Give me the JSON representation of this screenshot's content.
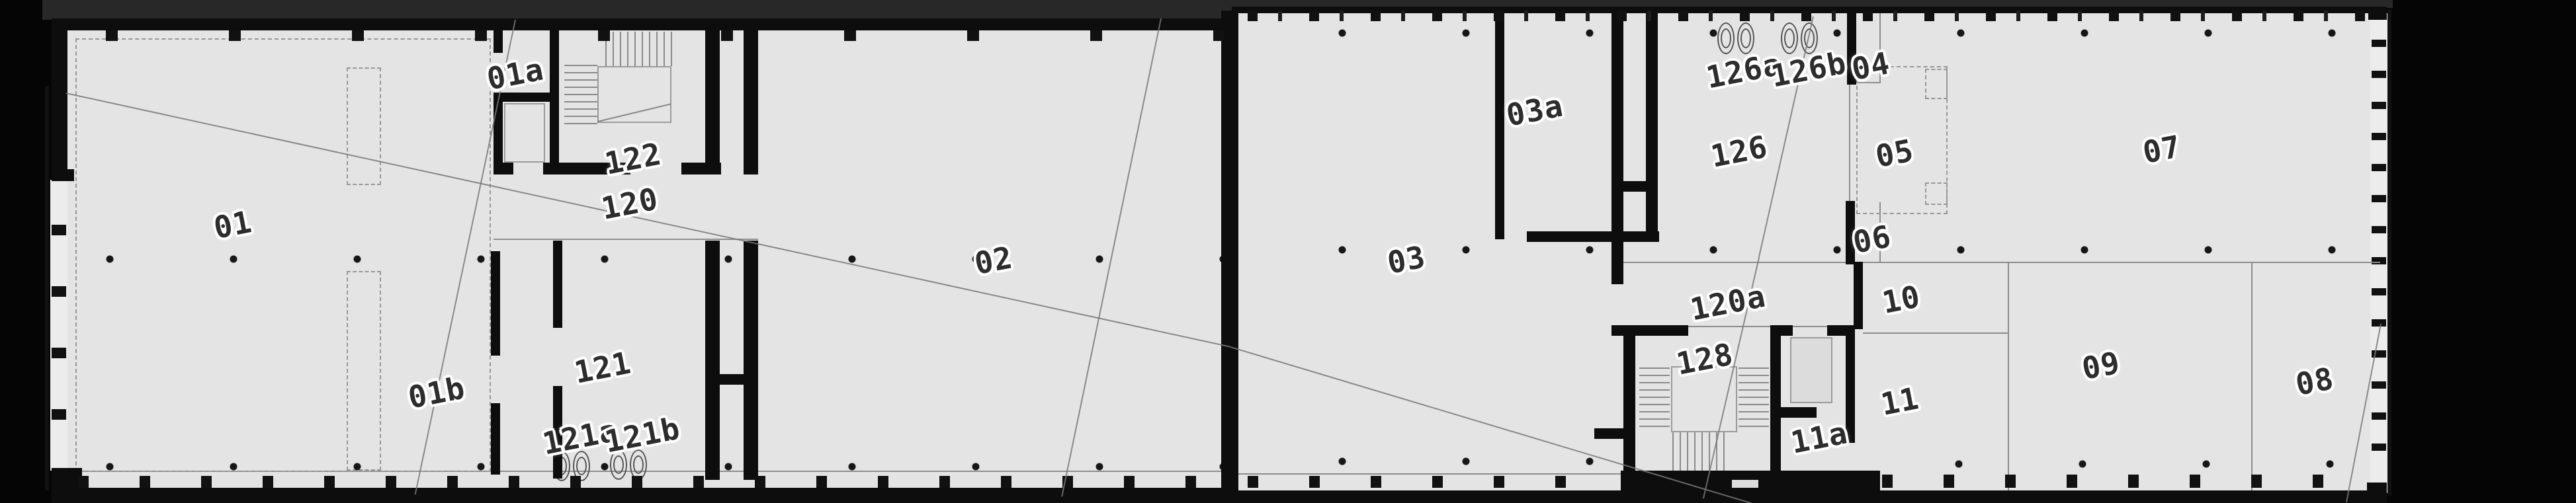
{
  "meta": {
    "document_type": "architectural floor plan (scanned drawing)",
    "content": "single-storey building plan, two joined wings, numbered rooms with stair cores, shafts and sanitary fixtures"
  },
  "colors": {
    "background": "#050505",
    "scan_band": "#282828",
    "floor": "#e4e4e4",
    "wall": "#0d0d0d",
    "thin_line": "#8d8d8d",
    "crease_line": "#787878",
    "label_text": "#2d2d2d",
    "label_halo": "#ffffff"
  },
  "labels": {
    "r01": "01",
    "r01a": "01a",
    "r01b": "01b",
    "r02": "02",
    "r03": "03",
    "r03a": "03a",
    "r04": "04",
    "r05": "05",
    "r06": "06",
    "r07": "07",
    "r08": "08",
    "r09": "09",
    "r10": "10",
    "r11": "11",
    "r11a": "11a",
    "r120": "120",
    "r120a": "120a",
    "r121": "121",
    "r121a": "121a",
    "r121b": "121b",
    "r122": "122",
    "r126": "126",
    "r126a": "126a",
    "r126b": "126b",
    "r128": "128"
  }
}
